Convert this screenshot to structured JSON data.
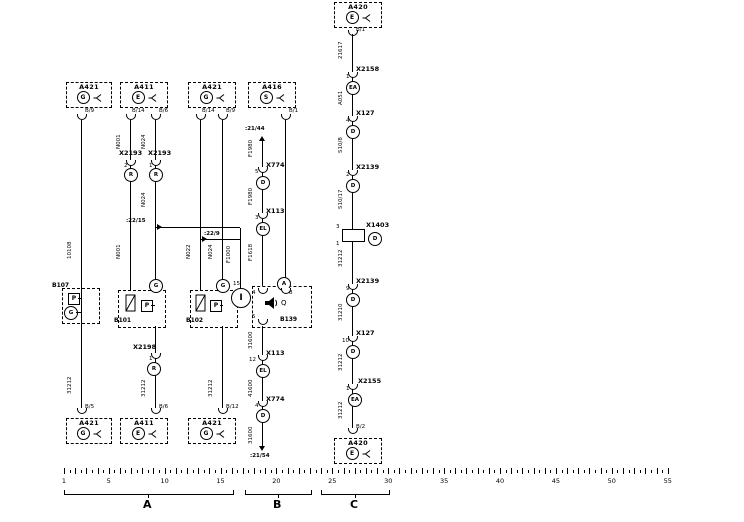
{
  "diagram": {
    "boxes": {
      "a421_tl": {
        "id": "A421",
        "letter": "G",
        "pin": "B/9"
      },
      "a411_t": {
        "id": "A411",
        "letter": "E",
        "pin_l": "B/14",
        "pin_r": "B/6"
      },
      "a421_tr": {
        "id": "A421",
        "letter": "G",
        "pin_l": "B/14",
        "pin_r": "B/9"
      },
      "a416_t": {
        "id": "A416",
        "letter": "S",
        "pin": "B/1"
      },
      "a420_t": {
        "id": "A420",
        "letter": "E",
        "pin": "B/1"
      },
      "a421_bl": {
        "id": "A421",
        "letter": "G",
        "pin": "B/5"
      },
      "a411_b": {
        "id": "A411",
        "letter": "E",
        "pin": "B/6"
      },
      "a421_br": {
        "id": "A421",
        "letter": "G",
        "pin": "B/12"
      },
      "a420_b": {
        "id": "A420",
        "letter": "E",
        "pin": "B/2"
      }
    },
    "connectors": {
      "x2193_l": {
        "id": "X2193",
        "pin": "2",
        "code": "R"
      },
      "x2193_r": {
        "id": "X2193",
        "pin": "1",
        "code": "R"
      },
      "x2198": {
        "id": "X2198",
        "pin": "1",
        "code": "R"
      },
      "x774_t": {
        "id": "X774",
        "pin": "5",
        "code": "D"
      },
      "x113_t": {
        "id": "X113",
        "pin": "3",
        "code": "EL"
      },
      "x113_b": {
        "id": "X113",
        "pin": "12",
        "code": "EL"
      },
      "x774_b": {
        "id": "X774",
        "pin": "4",
        "code": "D"
      },
      "x2158": {
        "id": "X2158",
        "pin": "1",
        "code": "EA"
      },
      "x127_a": {
        "id": "X127",
        "pin": "4",
        "code": "D"
      },
      "x2139_a": {
        "id": "X2139",
        "pin": "2",
        "code": "D"
      },
      "x1403": {
        "id": "X1403",
        "pin_a": "3",
        "pin_b": "1",
        "code": "D"
      },
      "x2139_b": {
        "id": "X2139",
        "pin": "9",
        "code": "D"
      },
      "x127_b": {
        "id": "X127",
        "pin": "10",
        "code": "D"
      },
      "x2155": {
        "id": "X2155",
        "pin": "1",
        "code": "EA"
      }
    },
    "components": {
      "b107": {
        "id": "B107",
        "sym": "P",
        "code": "G"
      },
      "b101": {
        "id": "B101",
        "sym": "P",
        "code": "G"
      },
      "b102": {
        "id": "B102",
        "sym": "P",
        "code": "G"
      },
      "b139": {
        "id": "B139",
        "code": "A",
        "pin_tl": "4",
        "pin_tr": "8",
        "pin_b": "5",
        "horn": "Q"
      },
      "i_comp": {
        "id": "I",
        "pin": "15"
      }
    },
    "wire_labels": {
      "w1_upper": "10108",
      "w1_lower": "31212",
      "w2_upper": "N001",
      "w2_mid": "N001",
      "w2_lower": "31212",
      "w3_upper": "N024",
      "w3_mid": "N024",
      "w4_mid": "N022",
      "w5_mid": "N024",
      "w5_lower": "31212",
      "wb_1": "F1980",
      "wb_2": "F1980",
      "wb_3": "F1618",
      "wb_4": "31600",
      "wb_5": "41600",
      "wb_6": "31600",
      "wi": "F1000",
      "wc_1": "21617",
      "wc_2": "A051",
      "wc_3": "S10/8",
      "wc_4": "S10/17",
      "wc_5": "31212",
      "wc_6": "31210",
      "wc_7": "31212",
      "wc_8": "31212"
    },
    "crossrefs": {
      "b_top": ":21/44",
      "b_bottom": ":21/54",
      "a_left": ":22/15",
      "a_right": ":22/9"
    },
    "ruler": {
      "numbers": [
        1,
        5,
        10,
        15,
        20,
        25,
        30,
        35,
        40,
        45,
        50,
        55
      ],
      "max": 55,
      "sections": [
        {
          "label": "A"
        },
        {
          "label": "B"
        },
        {
          "label": "C"
        }
      ]
    }
  }
}
